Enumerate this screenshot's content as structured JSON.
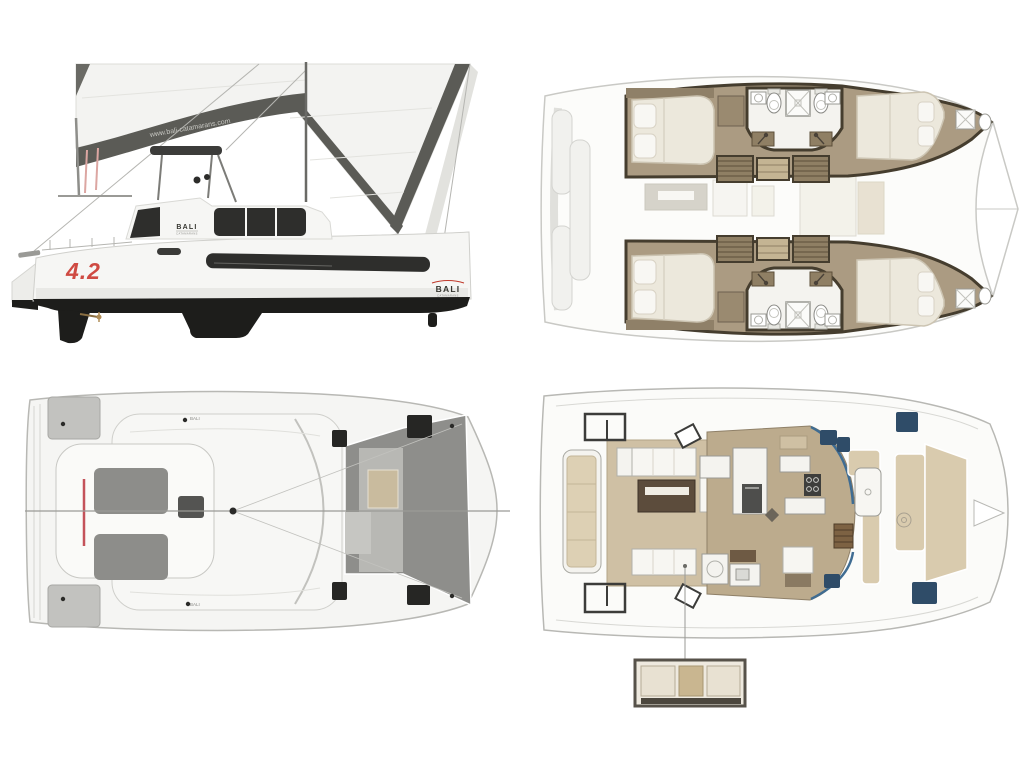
{
  "brand": {
    "sail_logo": "www.bali-catamarans.com",
    "coachroof_logo": "BALI",
    "coachroof_sub": "CATAMARANS",
    "bow_model": "4.2",
    "stern_logo": "BALI",
    "stern_sub": "CATAMARANS",
    "hull_mark_port": "BALI",
    "hull_mark_starboard": "BALI"
  },
  "palette": {
    "background": "#ffffff",
    "hull_white": "#f6f6f4",
    "underwater_black": "#1d1d1b",
    "glass_dark": "#2e2e2c",
    "sail_white": "#f3f3f1",
    "sail_band_gray": "#5b5b56",
    "accent_red": "#cf4a42",
    "davit_pink": "#dca6a2",
    "plan_floor_tan": "#ab9b82",
    "plan_wall_brown": "#453d2e",
    "bed_cream": "#ece8dc",
    "teak_stairs": "#8f7f64",
    "saloon_floor_tan": "#bcab8d",
    "cushion_beige": "#d9cbae",
    "deck_gray": "#8d8d8a",
    "hatch_black": "#262624",
    "hatch_navy": "#2f4c68",
    "glass_blue": "#3f6c92",
    "ghost_line": "#c9c9c5"
  }
}
